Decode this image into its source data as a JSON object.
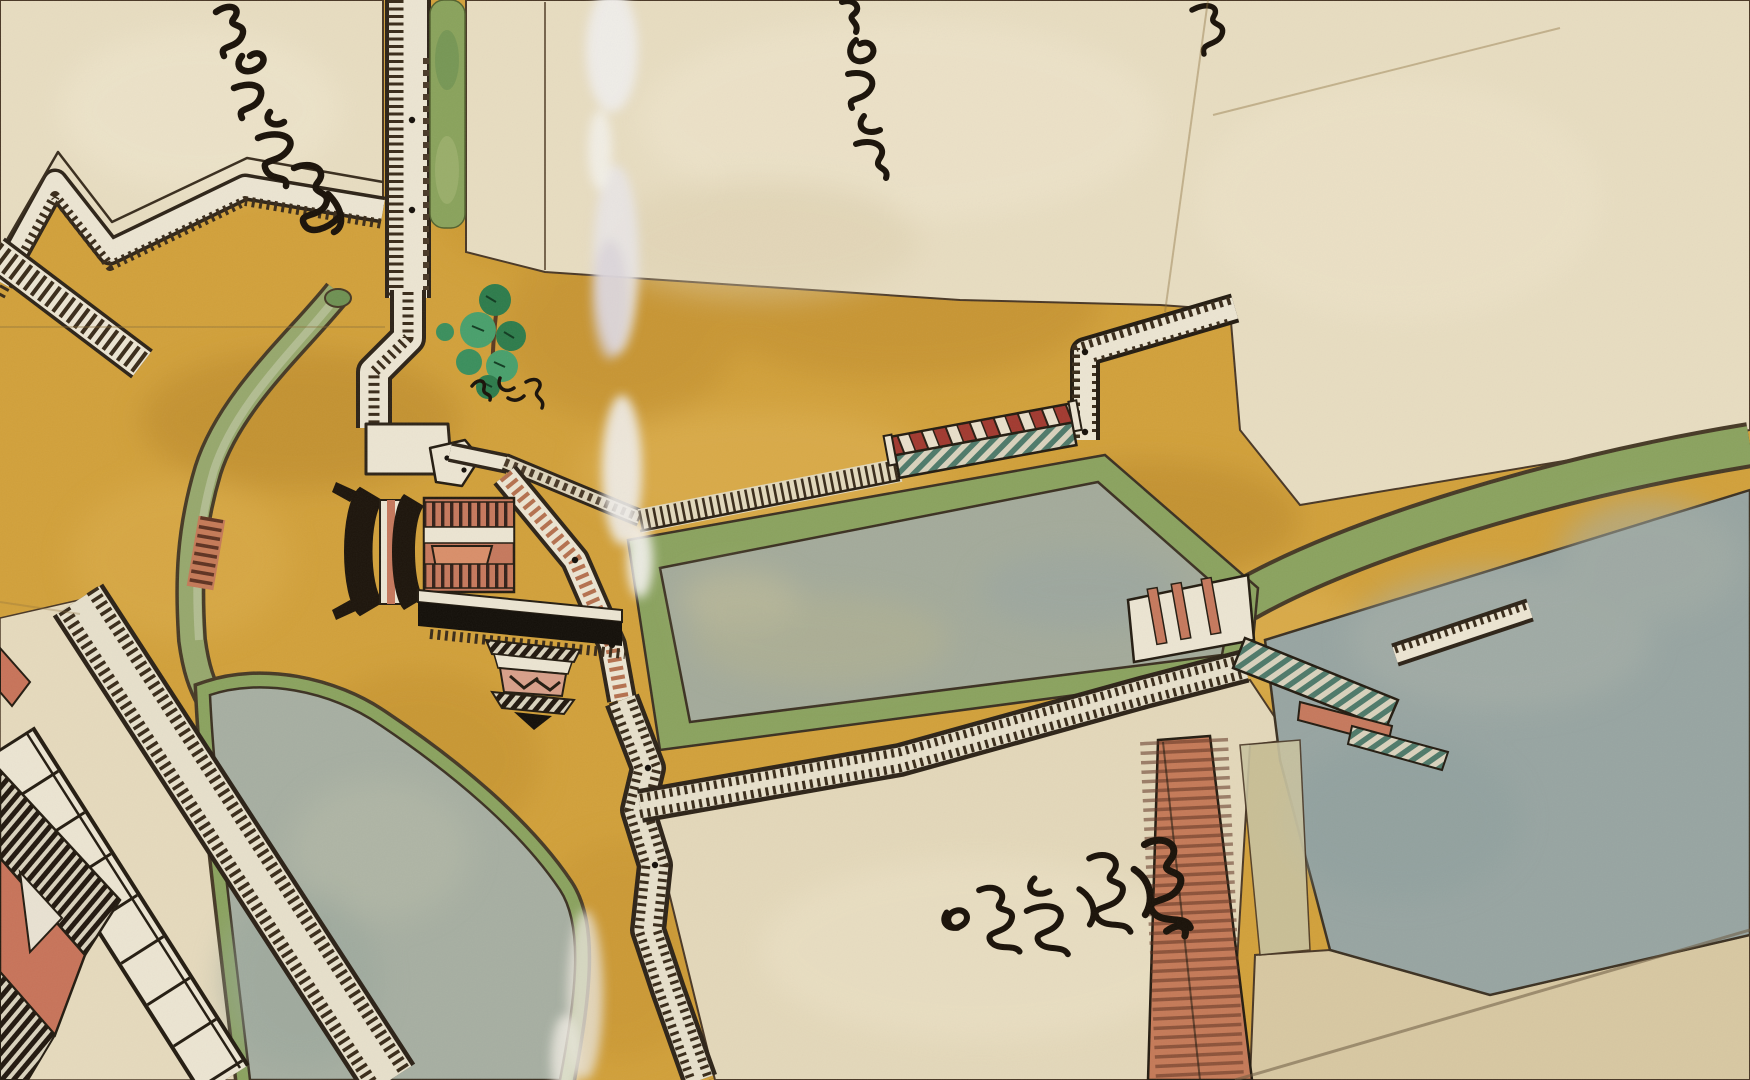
{
  "artwork": {
    "title": "Edo-period painted castle map (detail)",
    "medium": "ink and color wash on paper",
    "type": "historical Japanese castle-town plan, bird's-eye plan with gates drawn in elevation"
  },
  "palette": {
    "road_ochre": "#d2a13b",
    "road_ochre_dark": "#b8862b",
    "paper_cream": "#e8ddc1",
    "paper_cream_shadow": "#dccfae",
    "water_gray_green": "#a4ab9b",
    "water_blue_gray": "#98a5a2",
    "bank_green": "#8ba35f",
    "canal_green": "#97a86d",
    "wall_white": "#ece5d2",
    "ink_dark": "#2c2115",
    "ink_black": "#1a1209",
    "checker_red": "#a23a30",
    "salmon": "#c6795d",
    "teal_plank": "#4f7a6a",
    "pine_green": "#2e7c4c",
    "pine_green_light": "#49a06c",
    "damage_white": "#efedea",
    "fold_brown": "#8a6d3a",
    "tan_lowland": "#d8c8a2"
  },
  "map_features": {
    "blocks": [
      "upper-left compound with zigzag rampart edge",
      "large upper-central compound",
      "upper-right compound beyond fold crease",
      "inner compound at lower-left with buildings",
      "lower-central open ground between walls"
    ],
    "moats": [
      "central rectangular moat with green embankment",
      "large moat on the right with green bank and tan shallows",
      "curved pond at lower-left fed by a narrow green canal"
    ],
    "walls": [
      "vertical stone wall with hatched facing, upper centre",
      "zigzag rampart, upper-left",
      "double hatched rampart running diagonally, lower-left",
      "long hatched rampart below the central moat",
      "L-shaped wall at the bridgehead, upper-right"
    ],
    "structures": [
      "two-storey gate tower drawn in elevation, centre-left",
      "masugata (square gate enclosure) above the tower",
      "small secondary gate hanging below the black roof band",
      "eastern gate with teal plank roof on the far rampart",
      "bridge with red-and-white checkered railing and teal planking",
      "wooden stockade fence of close-set posts",
      "red plank causeway bridge crossing toward the bottom edge",
      "stepped spillway on the canal",
      "white-panelled corridor building, lower-left",
      "red-walled hall with dark hatched roof, lower-left corner"
    ],
    "vegetation": [
      "single pine tree painted in two greens beside the wall",
      "green verge strip along the upper wall"
    ],
    "damage": [
      "vertical streak of paper loss through the upper centre",
      "pale abrasion streak at bottom centre",
      "fold creases upper-right and lower-right"
    ]
  },
  "calligraphy_labels": [
    {
      "id": "upper-left",
      "script": "cursive kanji (kuzushiji)",
      "legible": false,
      "orientation": "diagonal, running down-right",
      "approx_chars": 4
    },
    {
      "id": "upper-center",
      "script": "cursive kanji (kuzushiji)",
      "legible": false,
      "orientation": "vertical column",
      "approx_chars": 3
    },
    {
      "id": "upper-right-edge",
      "script": "cursive kanji (kuzushiji)",
      "legible": false,
      "orientation": "partial, cut by top edge",
      "approx_chars": 1
    },
    {
      "id": "beside-pine-tree",
      "script": "small cursive kanji",
      "legible": false,
      "orientation": "horizontal",
      "approx_chars": 3
    },
    {
      "id": "lower-center",
      "script": "cursive kanji (kuzushiji)",
      "legible": false,
      "orientation": "horizontal, slightly rising to the right",
      "approx_chars": 5
    }
  ]
}
